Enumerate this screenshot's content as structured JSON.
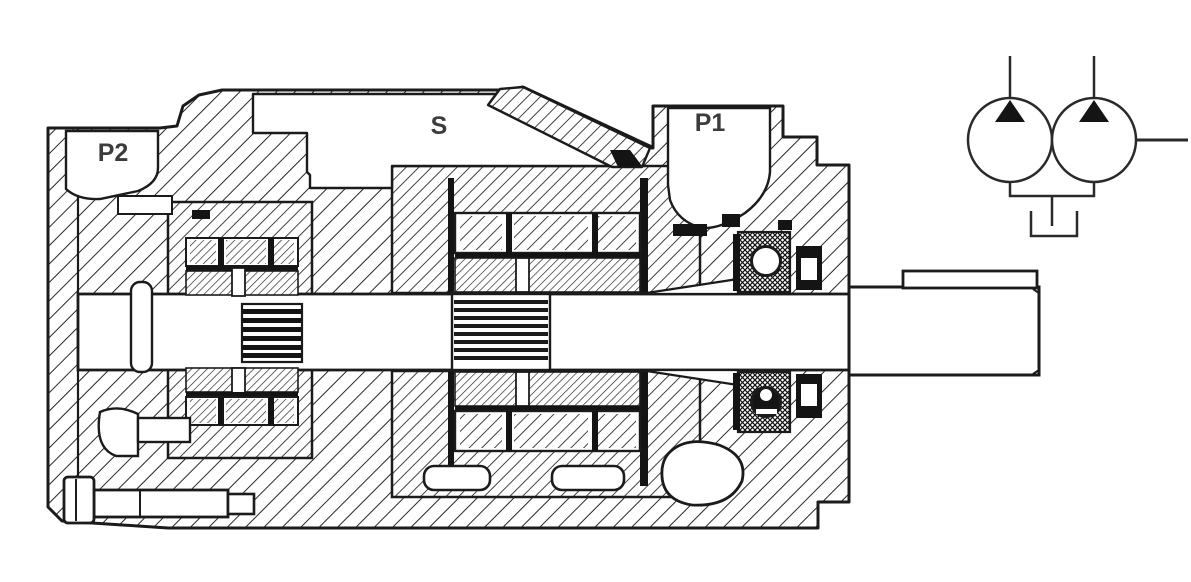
{
  "canvas": {
    "width": 1191,
    "height": 582,
    "background": "#ffffff"
  },
  "diagram": {
    "type": "technical-cross-section",
    "labels": {
      "port_p2": "P2",
      "suction_port": "S",
      "port_p1": "P1"
    },
    "colors": {
      "line": "#1b1b1b",
      "dark_fill": "#141414",
      "label_text": "#3c3c3c",
      "paper": "#ffffff"
    }
  },
  "schematic_symbol": {
    "icons": [
      "pump-circle-left-icon",
      "pump-circle-right-icon",
      "flow-arrow-left-icon",
      "flow-arrow-right-icon",
      "drive-shaft-line-icon",
      "tank-icon"
    ]
  }
}
